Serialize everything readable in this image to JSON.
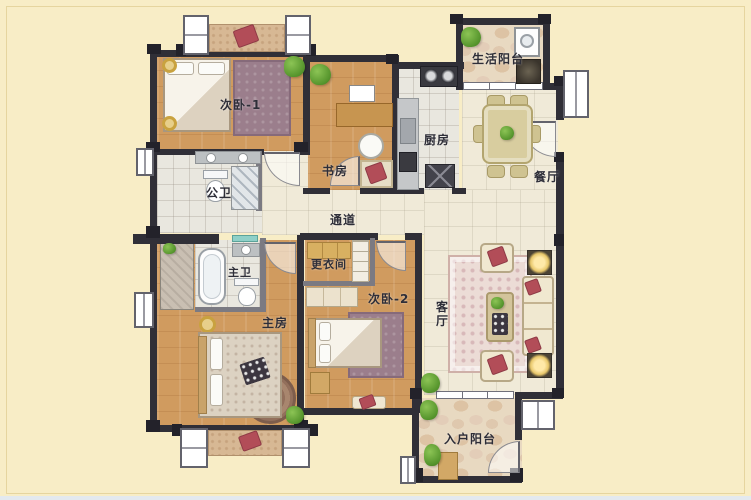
{
  "palette": {
    "background": "#f8edc6",
    "wall": "#302f37",
    "wood_floor": "#d09b5f",
    "tile_floor": "#e9e7df",
    "hall_floor": "#f0ead8",
    "stone_floor": "#e8d9c1",
    "rug_mauve": "#9b7e8c",
    "accent_red": "#b24d58",
    "plant_green": "#55942c",
    "label_color": "#2e2e38"
  },
  "rooms": {
    "bedroom1": {
      "label": "次卧-1"
    },
    "study": {
      "label": "书房"
    },
    "kitchen": {
      "label": "厨房"
    },
    "life_balcony": {
      "label": "生活阳台"
    },
    "dining": {
      "label": "餐厅"
    },
    "public_bath": {
      "label": "公卫"
    },
    "corridor": {
      "label": "通道"
    },
    "master_bath": {
      "label": "主卫"
    },
    "dressing": {
      "label": "更衣间"
    },
    "bedroom2": {
      "label": "次卧-2"
    },
    "master_bedroom": {
      "label": "主房"
    },
    "living": {
      "label": "客厅"
    },
    "entry_balcony": {
      "label": "入户阳台"
    }
  }
}
